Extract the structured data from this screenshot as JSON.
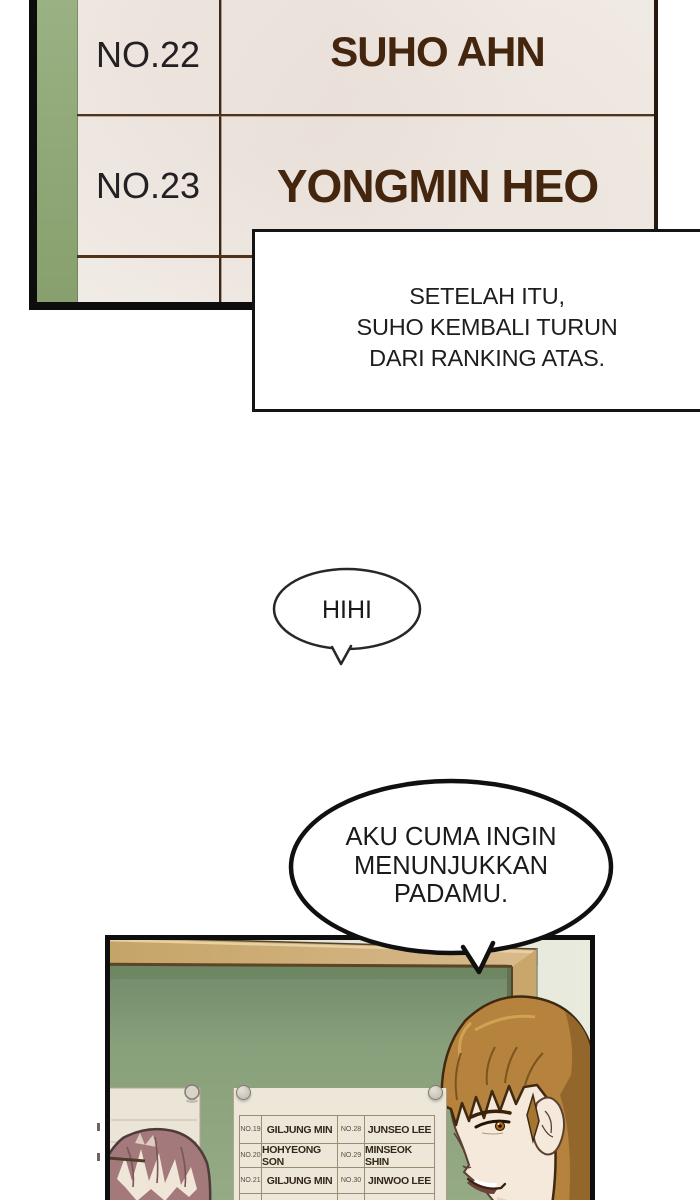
{
  "top_ranking_sheet": {
    "rows": [
      {
        "number": "NO.22",
        "name": "SUHO AHN"
      },
      {
        "number": "NO.23",
        "name": "YONGMIN HEO"
      }
    ],
    "colors": {
      "paper": "#f1ebe5",
      "green_strip": "#92a97c",
      "name_text": "#44250e",
      "number_text": "#242124",
      "divider": "#4c3421",
      "outer_border": "#0d0d0d"
    }
  },
  "narration_box": {
    "lines": [
      "SETELAH ITU,",
      "SUHO KEMBALI TURUN",
      "DARI RANKING ATAS."
    ]
  },
  "speech_bubbles": {
    "small": {
      "text": "HIHI"
    },
    "large": {
      "lines": [
        "AKU CUMA INGIN",
        "MENUNJUKKAN",
        "PADAMU."
      ]
    }
  },
  "panel": {
    "colors": {
      "wall": "#e4e7da",
      "wood_frame": "#cfae78",
      "chalkboard": "#87a17a",
      "border": "#0e0e0e",
      "paper": "#ece7d9",
      "hair_brown": "#b5833e",
      "hair_pink": "#a3797b"
    },
    "ranking_paper": {
      "rows": [
        {
          "no_left": "NO.19",
          "name_left": "GILJUNG MIN",
          "no_right": "NO.28",
          "name_right": "JUNSEO LEE"
        },
        {
          "no_left": "NO.20",
          "name_left": "HOHYEONG SON",
          "no_right": "NO.29",
          "name_right": "MINSEOK SHIN"
        },
        {
          "no_left": "NO.21",
          "name_left": "GILJUNG MIN",
          "no_right": "NO.30",
          "name_right": "JINWOO LEE"
        }
      ]
    }
  }
}
